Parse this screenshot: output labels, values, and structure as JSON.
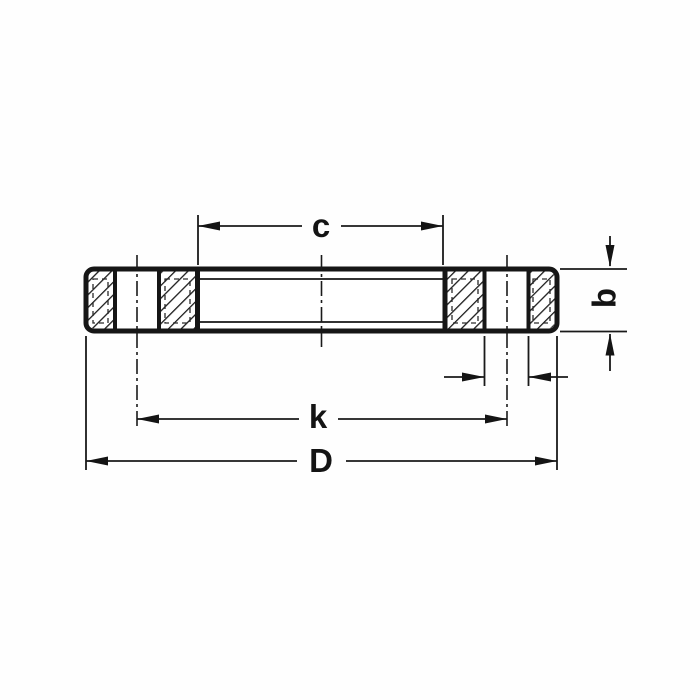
{
  "diagram": {
    "type": "technical-drawing",
    "subject": "flat plate flange cross-section with dimension lines",
    "labels": {
      "c": "c",
      "b": "b",
      "k": "k",
      "D": "D"
    },
    "colors": {
      "ink": "#161616",
      "paper": "#fefefe"
    }
  }
}
